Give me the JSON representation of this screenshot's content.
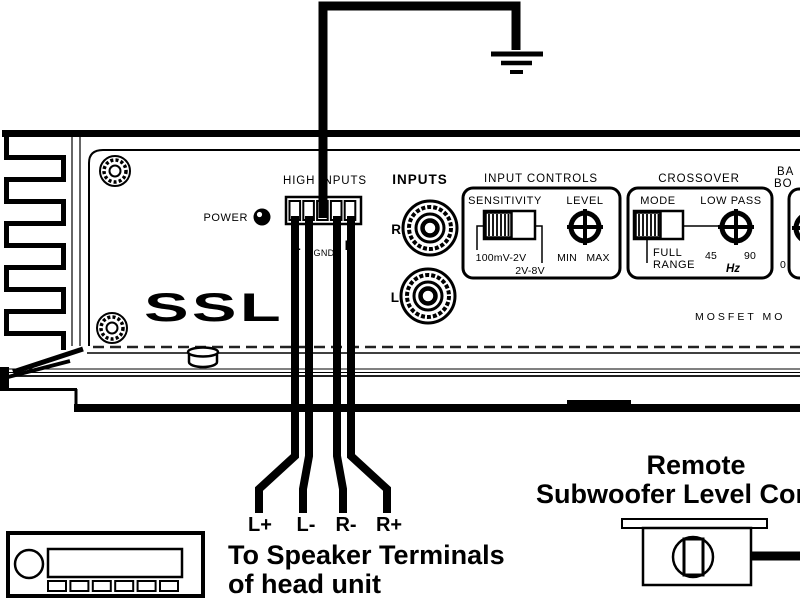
{
  "colors": {
    "ink": "#000000",
    "paper": "#ffffff"
  },
  "amplifier": {
    "brand": "SSL",
    "power_label": "POWER",
    "mosfet_text": "MOSFET MO",
    "high_inputs": {
      "title": "HIGH INPUTS",
      "pin_left": "L",
      "pin_center": "GND",
      "pin_right": "R"
    },
    "inputs": {
      "title": "INPUTS",
      "right_jack": "R",
      "left_jack": "L"
    },
    "input_controls": {
      "title": "INPUT CONTROLS",
      "sensitivity_label": "SENSITIVITY",
      "level_label": "LEVEL",
      "range_low": "100mV-2V",
      "range_high": "2V-8V",
      "min": "MIN",
      "max": "MAX"
    },
    "crossover": {
      "title": "CROSSOVER",
      "mode_label": "MODE",
      "low_pass_label": "LOW PASS",
      "mode_full": "FULL",
      "mode_range": "RANGE",
      "freq_low": "45",
      "freq_high": "90",
      "freq_unit": "Hz"
    },
    "bass_boost": {
      "title_line1": "BA",
      "title_line2": "BO",
      "scale_zero": "0"
    }
  },
  "wires": {
    "l_plus": "L+",
    "l_minus": "L-",
    "r_minus": "R-",
    "r_plus": "R+"
  },
  "captions": {
    "speaker_line1": "To Speaker Terminals",
    "speaker_line2": "of head unit",
    "remote_line1": "Remote",
    "remote_line2": "Subwoofer Level Con"
  }
}
